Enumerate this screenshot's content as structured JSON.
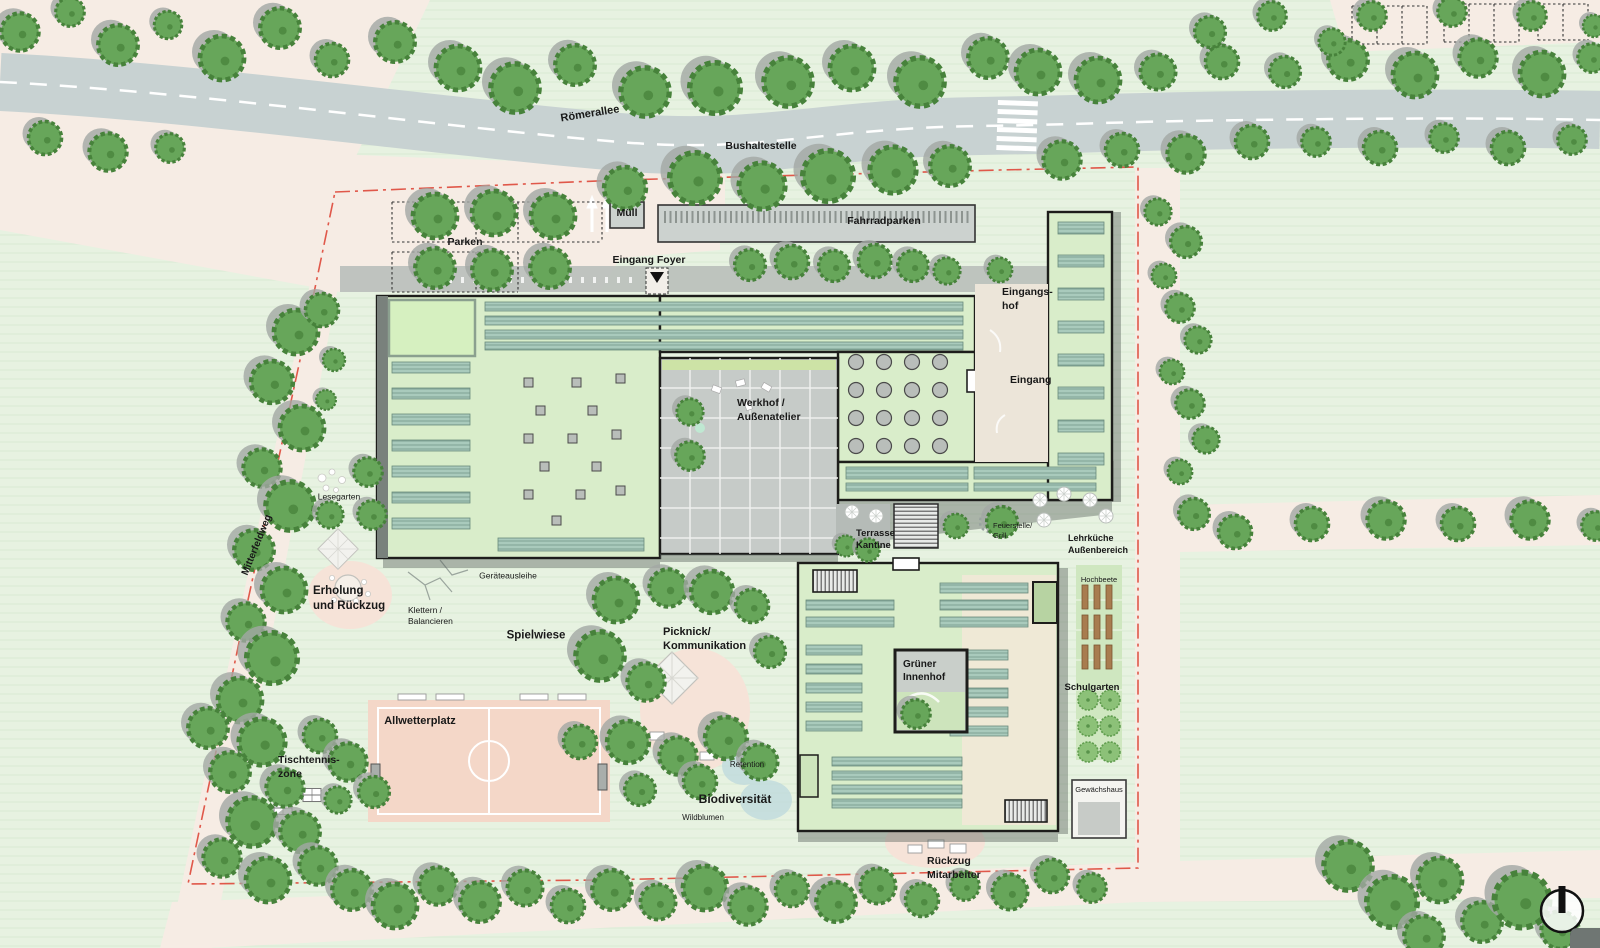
{
  "colors": {
    "field_green": "#e7f2e1",
    "field_stripe": "#ddecd8",
    "path_cream": "#f6ece4",
    "road_gray": "#c8d2d2",
    "tree_green": "#67a65a",
    "tree_edge": "#47823b",
    "tree_shadow": "#a3a8a4",
    "roof_green": "#d9edca",
    "skylight_blue": "#a9cabc",
    "courtyard_gray": "#c6cbc8",
    "entrance_cream": "#ece5d9",
    "sport_salmon": "#f4d7c8",
    "patio_pink": "#f6e3d8",
    "raised_bed_brown": "#a87c4f",
    "orchard_green": "#8cc178",
    "water_blue": "#bfdade",
    "boundary_red": "#e0584a",
    "outline_black": "#1d1d1b"
  },
  "labels": {
    "roemerallee": "Römerallee",
    "bushaltestelle": "Bushaltestelle",
    "parken": "Parken",
    "muell": "Müll",
    "fahrradparken": "Fahrradparken",
    "eingang_foyer": "Eingang Foyer",
    "eingangshof": "Eingangs-\nhof",
    "eingang": "Eingang",
    "werkhof": "Werkhof /\nAußenatelier",
    "lesegarten": "Lesegarten",
    "mitterfeldweg": "Mitterfeldweg",
    "erholung": "Erholung\nund Rückzug",
    "klettern": "Klettern /\nBalancieren",
    "spielwiese": "Spielwiese",
    "picknick": "Picknick/\nKommunikation",
    "geraeteausleihe": "Geräteausleihe",
    "terrasse_kantine": "Terrasse\nKantine",
    "feuerstelle_grill": "Feuerstelle/\nGrill",
    "lehrkueche": "Lehrküche\nAußenbereich",
    "hochbeete": "Hochbeete",
    "gruener_innenhof": "Grüner\nInnenhof",
    "schulgarten": "Schulgarten",
    "allwetterplatz": "Allwetterplatz",
    "tischtennis": "Tischtennis-\nzone",
    "retention": "Retention",
    "biodiversitaet": "Biodiversität",
    "wildblumen": "Wildblumen",
    "gewaechshaus": "Gewächshaus",
    "rueckzug_mitarbeiter": "Rückzug\nMitarbeiter"
  }
}
